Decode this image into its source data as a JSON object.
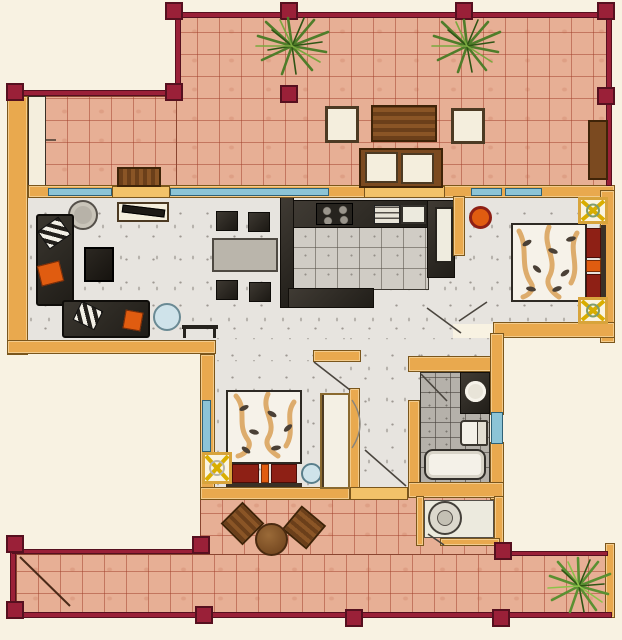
{
  "title": "hand-drawn-apartment-floor-plan",
  "palette": {
    "paper": "#f8f2e2",
    "tile": "#e7af95",
    "tileLine": "rgba(160,62,42,0.5)",
    "railing": "#9a2038",
    "railingDark": "#56101f",
    "wall": "#e9a94e",
    "wallEdge": "#7a561c",
    "threshold": "#f2c269",
    "window": "#8cc4d6",
    "windowEdge": "#2f6277",
    "floor": "#e7e4df",
    "kitchenFloor": "#d0ccc5",
    "bathFloor": "#b5b1aa",
    "wood": "#7b4a20",
    "woodDark": "#3f2408",
    "bedRed": "#8e2015",
    "orange": "#e05c10",
    "yellowX": "#d9ae00",
    "blueGlass": "#cfe3ea",
    "plantGreen": "#4f7d2a",
    "swirlTan": "#d79b4e",
    "furnitureDark": "#2b2722"
  },
  "rooms": [
    {
      "name": "terrace-top",
      "furniture": [
        "palm-plant",
        "palm-plant",
        "outdoor-armchair",
        "slatted-table",
        "outdoor-armchair",
        "outdoor-sofa",
        "wood-bench",
        "door-mat"
      ]
    },
    {
      "name": "living-room",
      "furniture": [
        "corner-sofa",
        "sofa",
        "coffee-table",
        "round-side-table",
        "x-frame-side-table",
        "round-glass-table",
        "tv-sideboard",
        "console-table",
        "striped-pillow",
        "striped-pillow",
        "orange-pillow",
        "orange-pillow"
      ]
    },
    {
      "name": "dining-area",
      "furniture": [
        "dining-table",
        "chair",
        "chair",
        "chair",
        "chair"
      ]
    },
    {
      "name": "kitchen",
      "furniture": [
        "stove-4-burners",
        "drawer-unit",
        "sink",
        "tall-fridge",
        "counter-left",
        "counter-right",
        "peninsula-counter"
      ]
    },
    {
      "name": "bedroom-right",
      "furniture": [
        "double-bed",
        "red-pillows",
        "x-frame-nightstand",
        "x-frame-nightstand",
        "orange-stool"
      ]
    },
    {
      "name": "bedroom-bottom",
      "furniture": [
        "double-bed",
        "red-pillows",
        "x-frame-nightstand",
        "round-glass-table",
        "wardrobe"
      ]
    },
    {
      "name": "bathroom",
      "furniture": [
        "vanity-sink",
        "toilet",
        "bathtub"
      ]
    },
    {
      "name": "utility",
      "furniture": [
        "washing-machine"
      ]
    },
    {
      "name": "terrace-bottom",
      "furniture": [
        "wood-chair",
        "wood-chair",
        "round-wood-table",
        "green-plant",
        "stair-line"
      ]
    }
  ],
  "railing_posts": 15,
  "windows": 7,
  "door_swings": 7
}
